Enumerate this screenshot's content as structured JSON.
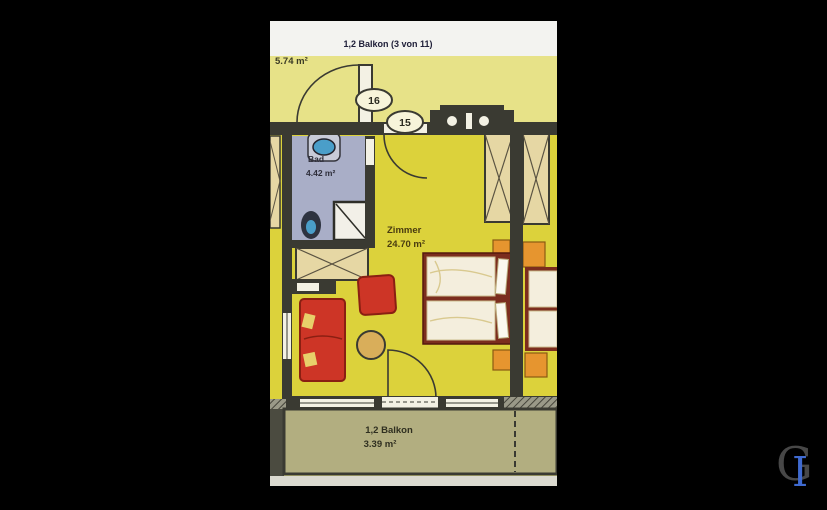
{
  "viewer": {
    "background_color": "#000000"
  },
  "photo": {
    "header": {
      "title": "1,2 Balkon (3 von 11)"
    },
    "plan": {
      "hall_area_label": "5.74 m²",
      "door_marker_16": "16",
      "door_marker_15": "15",
      "bathroom": {
        "name": "Bad",
        "area": "4.42 m²"
      },
      "room": {
        "name": "Zimmer",
        "area": "24.70 m²"
      },
      "balcony": {
        "name": "1,2 Balkon",
        "area": "3.39 m²"
      }
    },
    "colors": {
      "room_floor": "#dcd23b",
      "hall_floor": "#e7e288",
      "bathroom_floor": "#a9aec7",
      "balcony_floor": "#b2ae80",
      "wall": "#3a3a32",
      "wardrobe": "#e6d7a4",
      "bed_frame": "#7b2d1e",
      "bedding": "#f4eedd",
      "nightstand": "#e6952f",
      "sofa_red": "#cd3526",
      "table_tan": "#d9ae5a",
      "sanitary_blue": "#4a9ec9"
    }
  },
  "watermark": {
    "letter_dark": "G",
    "letter_blue": "I"
  }
}
